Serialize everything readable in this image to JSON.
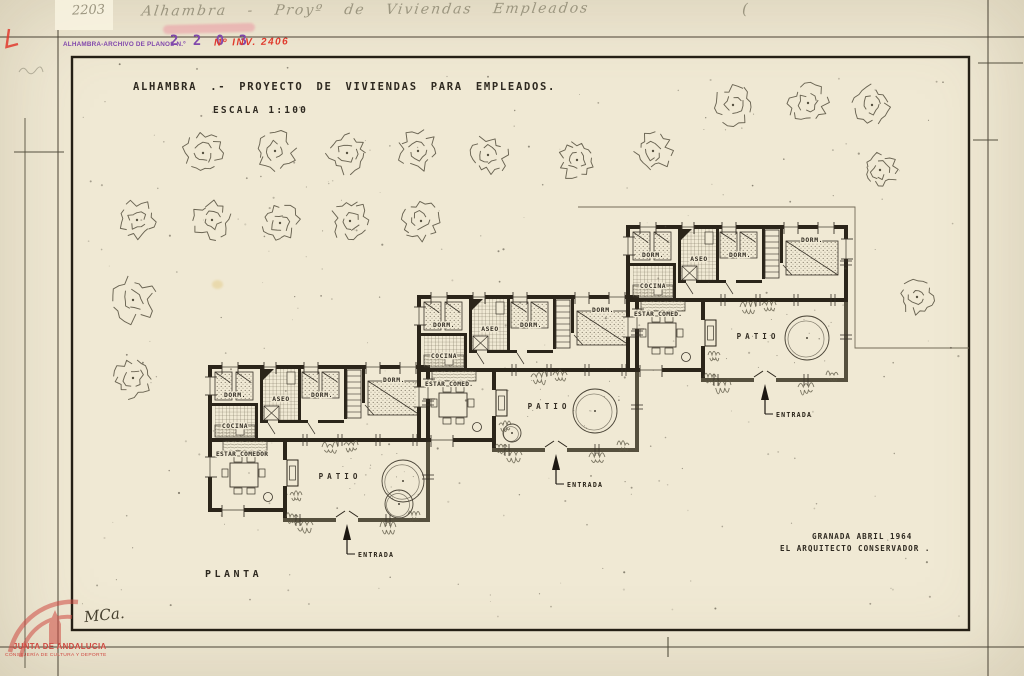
{
  "document": {
    "handwritten_left": "2203",
    "handwritten_main": "Alhambra - Proyº de Viviendas Empleados",
    "handwritten_paren": "(",
    "stamp": {
      "archive_label": "ALHAMBRA-ARCHIVO DE PLANOS N.º",
      "archive_number": "2 2 0 3",
      "inventory_label": "Nº INV. 2406"
    },
    "title": "ALHAMBRA .- PROYECTO DE VIVIENDAS PARA EMPLEADOS.",
    "scale": "ESCALA 1:100",
    "plan_label": "PLANTA",
    "date_line1": "GRANADA ABRIL 1964",
    "date_line2": "EL ARQUITECTO CONSERVADOR .",
    "signature": "MCa.",
    "watermark": {
      "line1": "JUNTA DE ANDALUCIA",
      "line2": "CONSEJERÍA DE CULTURA Y DEPORTE"
    }
  },
  "colors": {
    "paper": "#f0e9d4",
    "ink": "#2b251a",
    "patio_wall": "#56503e",
    "thin_line": "#4a4335",
    "tree": "#565140",
    "stamp_purple": "#8148ac",
    "stamp_red": "#e03a2c",
    "watermark_red": "#cf4a42",
    "pencil": "#9b957f"
  },
  "units": [
    {
      "name": "house-unit-1",
      "x": 208,
      "y": 365,
      "labels": {
        "dorm1": "DORM.",
        "aseo": "ASEO",
        "dorm2": "DORM.",
        "dorm3": "DORM.",
        "cocina": "COCINA",
        "estar": "ESTAR COMEDOR",
        "patio": "PATIO",
        "entrada": "ENTRADA"
      },
      "patio_circles": [
        [
          195,
          116,
          21
        ],
        [
          191,
          139,
          14
        ]
      ]
    },
    {
      "name": "house-unit-2",
      "x": 417,
      "y": 295,
      "labels": {
        "dorm1": "DORM.",
        "aseo": "ASEO",
        "dorm2": "DORM.",
        "dorm3": "DORM.",
        "cocina": "COCINA",
        "estar": "ESTAR COMED.",
        "patio": "PATIO",
        "entrada": "ENTRADA"
      },
      "patio_circles": [
        [
          178,
          116,
          22
        ],
        [
          95,
          138,
          9
        ]
      ]
    },
    {
      "name": "house-unit-3",
      "x": 626,
      "y": 225,
      "labels": {
        "dorm1": "DORM.",
        "aseo": "ASEO",
        "dorm2": "DORM.",
        "dorm3": "DORM.",
        "cocina": "COCINA",
        "estar": "ESTAR COMED.",
        "patio": "PATIO",
        "entrada": "ENTRADA"
      },
      "patio_circles": [
        [
          181,
          113,
          22
        ]
      ]
    }
  ],
  "site": {
    "trees": [
      [
        203,
        153,
        19
      ],
      [
        275,
        151,
        19
      ],
      [
        347,
        153,
        19
      ],
      [
        418,
        151,
        19
      ],
      [
        488,
        155,
        18
      ],
      [
        577,
        160,
        19
      ],
      [
        653,
        151,
        18
      ],
      [
        733,
        105,
        19
      ],
      [
        808,
        103,
        19
      ],
      [
        872,
        105,
        18
      ],
      [
        880,
        170,
        17
      ],
      [
        137,
        220,
        18
      ],
      [
        212,
        220,
        18
      ],
      [
        280,
        223,
        18
      ],
      [
        350,
        221,
        18
      ],
      [
        421,
        221,
        18
      ],
      [
        133,
        300,
        21
      ],
      [
        133,
        378,
        19
      ],
      [
        917,
        297,
        16
      ]
    ],
    "boundary": [
      [
        578,
        207
      ],
      [
        855,
        207
      ],
      [
        855,
        348
      ],
      [
        969,
        348
      ]
    ]
  }
}
